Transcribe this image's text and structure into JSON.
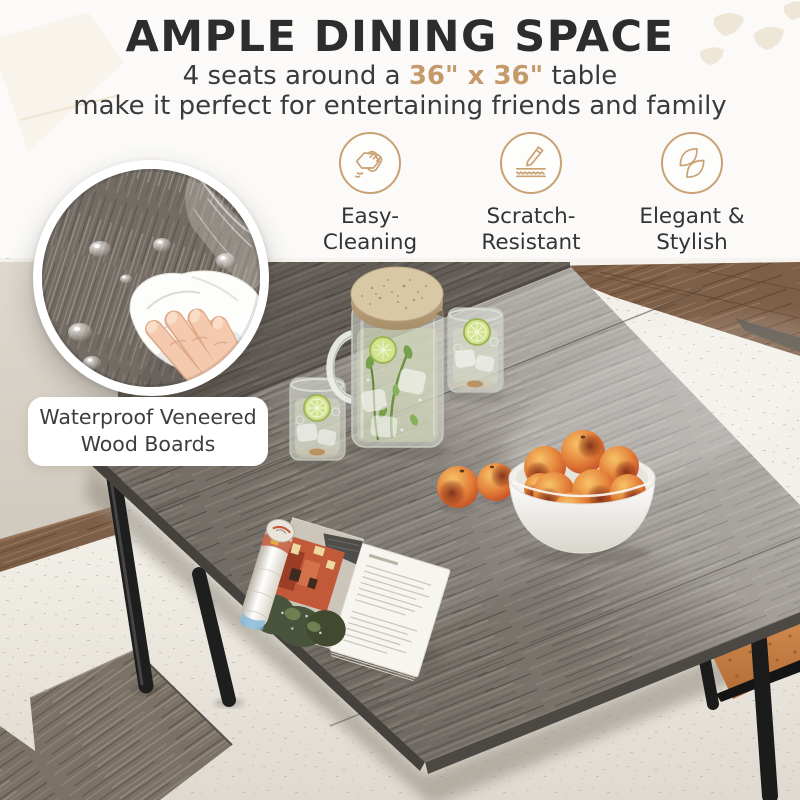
{
  "header": {
    "title": "AMPLE DINING SPACE",
    "subtitle": {
      "prefix": "4 seats around a ",
      "highlight": "36\" x 36\"",
      "suffix": " table"
    },
    "subtitle_line2": "make it perfect for entertaining friends and family"
  },
  "features": [
    {
      "icon": "hand-wipe-icon",
      "line1": "Easy-",
      "line2": "Cleaning"
    },
    {
      "icon": "scratch-blade-icon",
      "line1": "Scratch-",
      "line2": "Resistant"
    },
    {
      "icon": "leaf-pair-icon",
      "line1": "Elegant &",
      "line2": "Stylish"
    }
  ],
  "callout": {
    "line1": "Waterproof Veneered",
    "line2": "Wood Boards"
  },
  "colors": {
    "accent_tan": "#c59a6b",
    "icon_ring": "#c9a173",
    "title_dark": "#2d2d2d",
    "body_text": "#3b3b3b",
    "table_wood_gray": "#7e7770",
    "floor_white": "#f3f0e9",
    "wood_floor_brown": "#7d5e47",
    "bench_cushion_orange": "#c98045",
    "metal_leg_black": "#1e1e1e"
  },
  "scene": {
    "objects": [
      "dining-table",
      "water-pitcher",
      "drinking-glasses",
      "fruit-bowl",
      "peaches",
      "open-magazine",
      "wood-bench",
      "orange-bench-cushion",
      "metal-legs",
      "wiping-hand-with-cloth",
      "water-droplets"
    ]
  }
}
